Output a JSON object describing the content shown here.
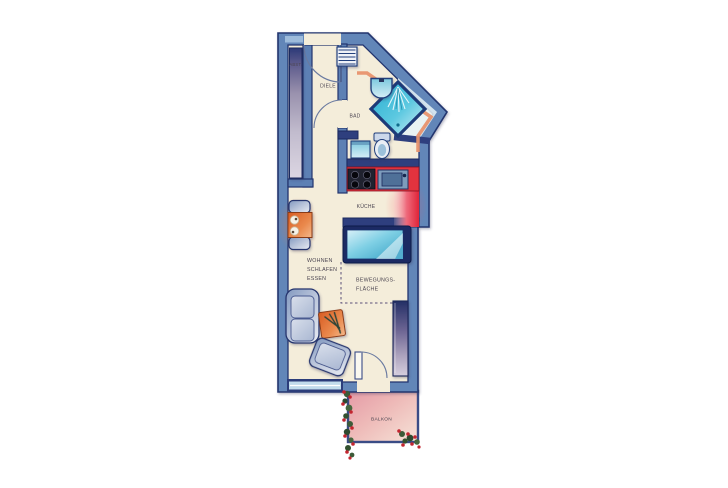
{
  "floorplan": {
    "labels": {
      "storage": "ABST.",
      "hall": "DIELE",
      "bath": "BAD",
      "kitchen": "KÜCHE",
      "living": [
        "WOHNEN",
        "SCHLAFEN",
        "ESSEN"
      ],
      "movement": [
        "BEWEGUNGS-",
        "FLÄCHE"
      ],
      "balcony": "BALKON"
    },
    "colors": {
      "wall_fill": "#6286b8",
      "wall_outline": "#22346e",
      "floor": "#f4edda",
      "partition_navy": "#2e3f7e",
      "accent_salmon": "#e8936e",
      "kitchen_counter_red": "#e2333e",
      "shower_cyan": "#35b6d9",
      "furniture_steel": "#9aaecd",
      "furniture_orange": "#e06a35",
      "balcony_pink": "#e8a0a8",
      "flower_red": "#c2252f",
      "flower_green": "#3d5a3a",
      "label_text": "#4a4450"
    },
    "fixtures": [
      "entrance-door",
      "hall-shelf",
      "storage-cabinet",
      "washbasin",
      "shower",
      "toilet",
      "washing-machine",
      "stove",
      "kitchen-sink",
      "kitchen-counter",
      "bed",
      "dining-table",
      "dining-chairs",
      "sofa",
      "side-table",
      "armchair",
      "wardrobe",
      "window",
      "balcony-door",
      "balcony-flowers"
    ]
  }
}
